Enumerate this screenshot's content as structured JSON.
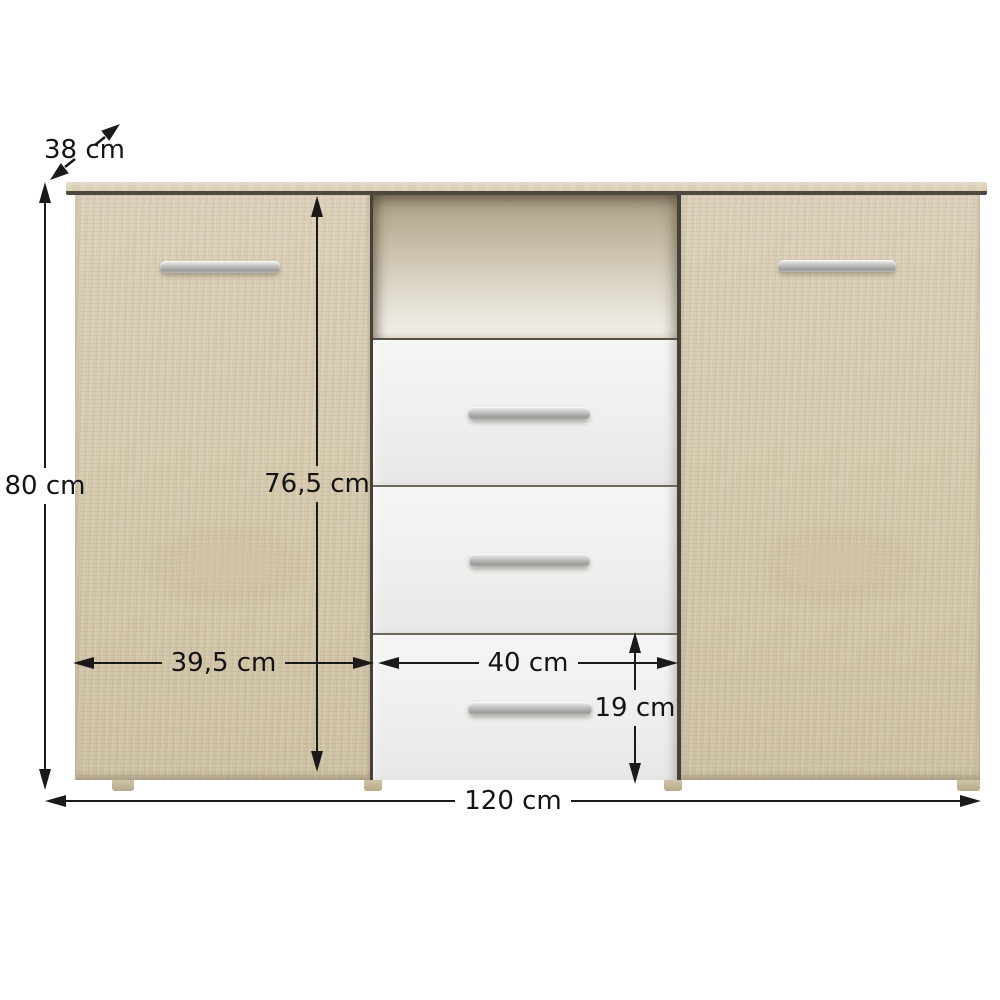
{
  "diagram": {
    "dimensions": [
      {
        "id": "depth",
        "label": "38 cm"
      },
      {
        "id": "height",
        "label": "80 cm"
      },
      {
        "id": "interior-height",
        "label": "76,5 cm"
      },
      {
        "id": "left-door-width",
        "label": "39,5 cm"
      },
      {
        "id": "drawer-width",
        "label": "40 cm"
      },
      {
        "id": "drawer-height",
        "label": "19 cm"
      },
      {
        "id": "total-width",
        "label": "120 cm"
      }
    ],
    "furniture": {
      "doors": 2,
      "drawers": 3,
      "open_shelf": 1,
      "handles": 5,
      "feet": 4
    },
    "colors": {
      "wood": "#d5c9ae",
      "wood_top_board": "#ddd3bc",
      "niche_shadow": "#ab9f87",
      "drawer_front": "#f1f1ef",
      "handle_metal": "#b3b3b3",
      "divider_line": "#6e675e",
      "dimension_line": "#1a1a1a",
      "background": "#ffffff"
    }
  }
}
